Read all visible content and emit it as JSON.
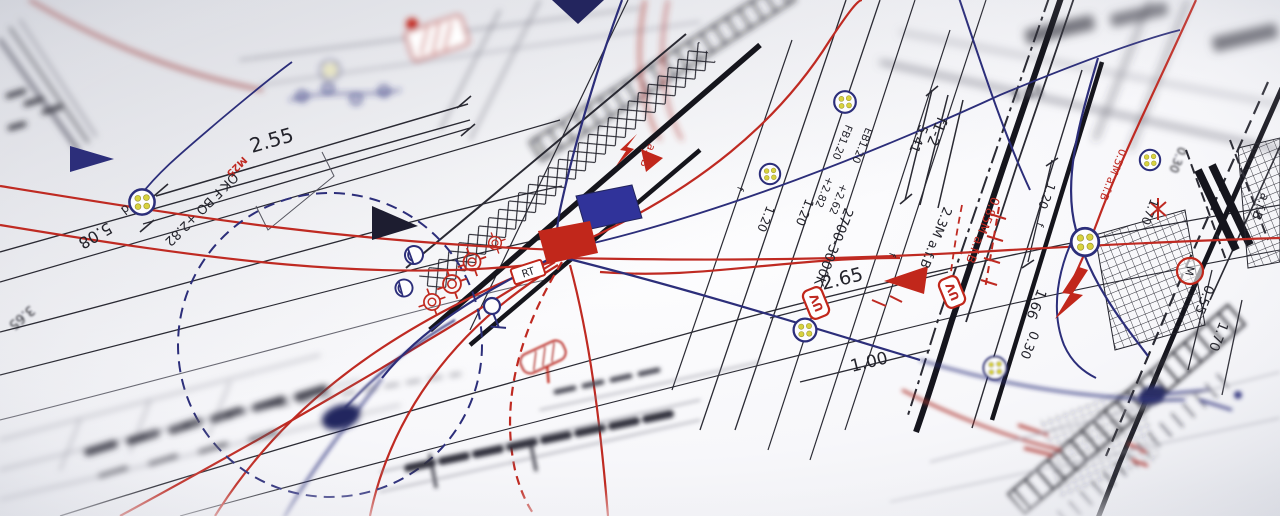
{
  "colors": {
    "paper": "#f8f8fb",
    "ink_black": "#23232b",
    "ink_gray": "#6a6a74",
    "ink_red": "#bf2a22",
    "ink_navy": "#2c2e7a",
    "cable_dot_yellow": "#d8d23e"
  },
  "labels": {
    "dim_2_55": "2.55",
    "m25": "M25",
    "ok_f_bo": "OK F BO +2.82",
    "d_mark": "d",
    "dim_5_08": "5.08",
    "dim_3_65": "3.65",
    "dim_3_48": "3.48",
    "f1_2": "f1-2",
    "dim_5_41": "5.41",
    "fb1_20": "FB1.20",
    "eb1_20": "EB1.20",
    "plus_2_82": "+2.82",
    "plus_2_62": "+2.62",
    "kelvin_range": "2700-3000K",
    "dim_1_20": "1.20",
    "afb_2_3m": "2.3M a.f.B",
    "afb_0_85m": "0.85M a.f.B",
    "afb_0_5m": "0.5M a.f.B",
    "afb": "a.f.B",
    "dim_2_65": "2.65",
    "uv_tag": "UV",
    "rt_tag": "RT",
    "dim_1_66": "1.66",
    "dim_1_00": "1.00",
    "dim_0_30": "0.30",
    "dim_0_55": "0.55",
    "dim_1_70": "1.70",
    "f_mark": "f",
    "motor_m": "M"
  }
}
